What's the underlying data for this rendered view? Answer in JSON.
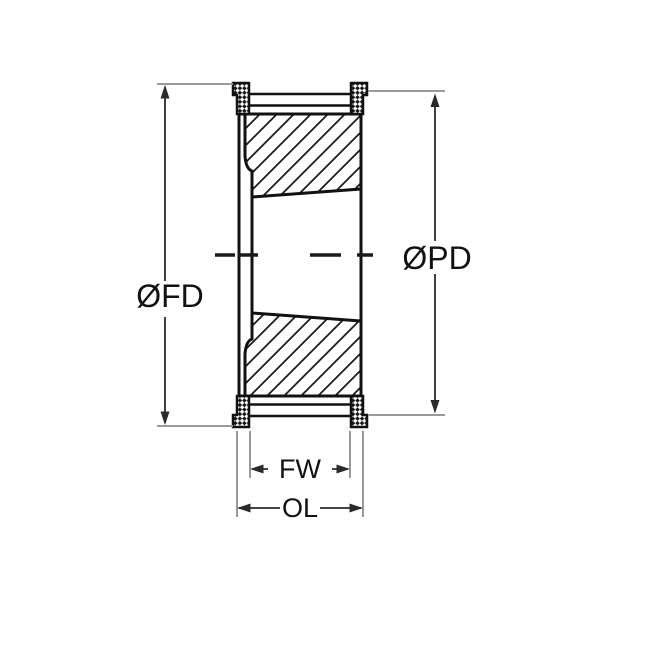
{
  "diagram": {
    "description": "Timing pulley cross-section drawing with taper bush bore, flanges and dimension callouts",
    "labels": {
      "flange_diameter": "ØFD",
      "pitch_diameter": "ØPD",
      "face_width": "FW",
      "overall_length": "OL"
    },
    "colors": {
      "background": "#ffffff",
      "part_outline": "#111111",
      "dimension_line": "#2a2a2a",
      "extension_line": "#9a9a9a",
      "text": "#111111"
    }
  }
}
